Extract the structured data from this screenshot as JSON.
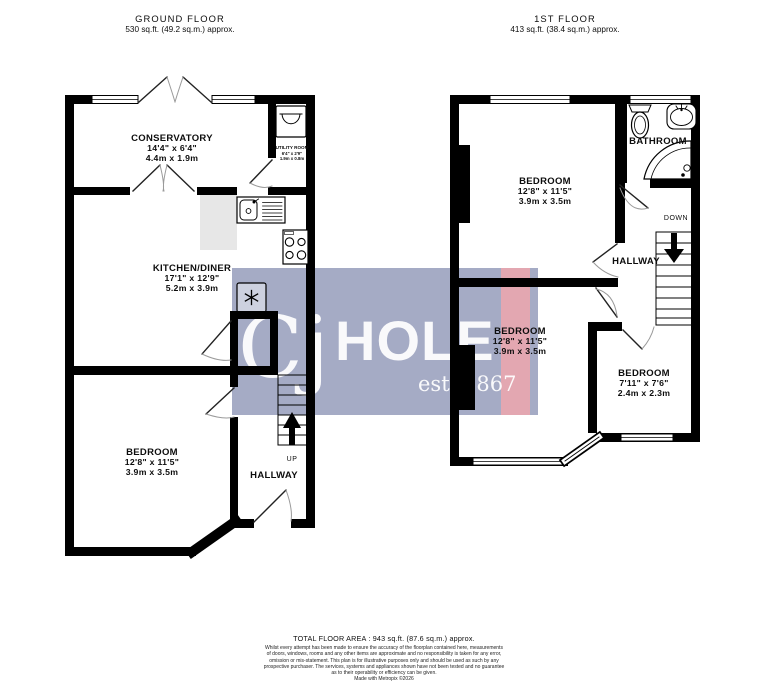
{
  "document": {
    "background": "#ffffff",
    "type": "floorplan"
  },
  "headers": {
    "ground": {
      "title": "GROUND FLOOR",
      "area": "530 sq.ft. (49.2 sq.m.) approx."
    },
    "first": {
      "title": "1ST FLOOR",
      "area": "413 sq.ft. (38.4 sq.m.) approx."
    }
  },
  "ground_floor": {
    "conservatory": {
      "name": "CONSERVATORY",
      "imperial": "14'4\" x 6'4\"",
      "metric": "4.4m x 1.9m"
    },
    "utility": {
      "name": "UTILITY ROOM",
      "imperial": "6'4\" x 2'9\"",
      "metric": "1.9m x 0.8m"
    },
    "kitchen": {
      "name": "KITCHEN/DINER",
      "imperial": "17'1\" x 12'9\"",
      "metric": "5.2m x 3.9m"
    },
    "bedroom": {
      "name": "BEDROOM",
      "imperial": "12'8\" x 11'5\"",
      "metric": "3.9m x 3.5m"
    },
    "hallway": "HALLWAY",
    "stairs_direction": "UP"
  },
  "first_floor": {
    "bathroom": "BATHROOM",
    "bedroom1": {
      "name": "BEDROOM",
      "imperial": "12'8\" x 11'5\"",
      "metric": "3.9m x 3.5m"
    },
    "bedroom2": {
      "name": "BEDROOM",
      "imperial": "12'8\" x 11'5\"",
      "metric": "3.9m x 3.5m"
    },
    "bedroom3": {
      "name": "BEDROOM",
      "imperial": "7'11\" x 7'6\"",
      "metric": "2.4m x 2.3m"
    },
    "hallway": "HALLWAY",
    "stairs_direction": "DOWN"
  },
  "watermark": {
    "brand_c": "Cj",
    "brand_main": "HOLE",
    "established": "est. 1867",
    "bg_color": "#a5abc5",
    "stripe_color": "#e3a7b1"
  },
  "footer": {
    "total": "TOTAL FLOOR AREA : 943 sq.ft. (87.6 sq.m.) approx.",
    "disclaimer": [
      "Whilst every attempt has been made to ensure the accuracy of the floorplan contained here, measurements",
      "of doors, windows, rooms and any other items are approximate and no responsibility is taken for any error,",
      "omission or mis-statement. This plan is for illustrative purposes only and should be used as such by any",
      "prospective purchaser. The services, systems and appliances shown have not been tested and no guarantee",
      "as to their operability or efficiency can be given."
    ],
    "credit": "Made with Metropix ©2026"
  },
  "colors": {
    "wall": "#000000",
    "counter": "#e7e7e7"
  }
}
